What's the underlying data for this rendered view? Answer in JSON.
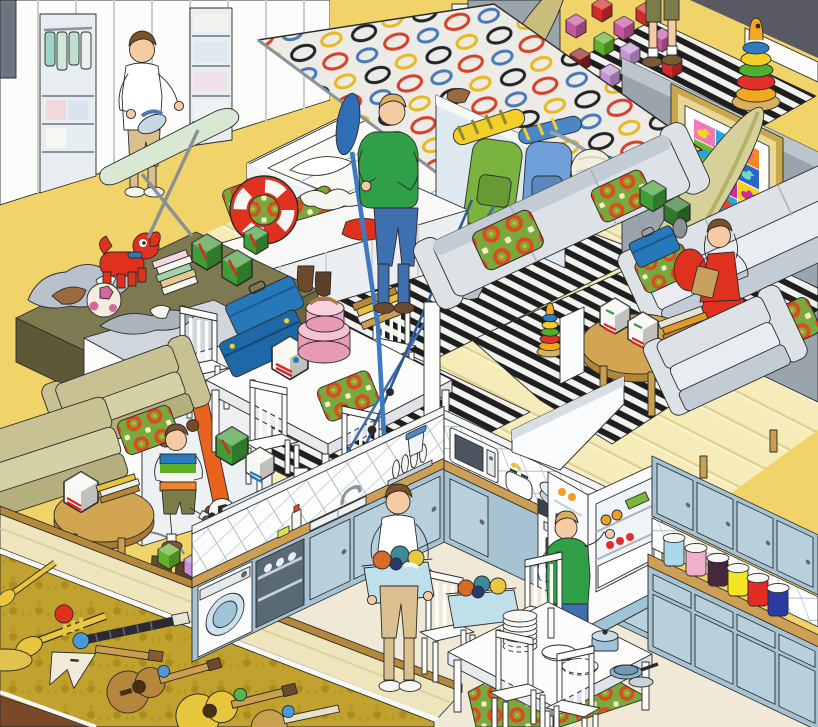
{
  "scene": {
    "title": "Isometric cutaway illustration of a cluttered family home",
    "style": "flat-color isometric cartoon with black outlines",
    "setting": "open-plan upper floor (closet, bedroom, living room, family area, kitchen) over a music room strewn with instruments"
  },
  "palette": {
    "floorYellow": "#f0d369",
    "floorPlank": "#f6ecba",
    "plankLine": "#e2d193",
    "floorCream": "#f0e9d7",
    "carpetOlive": "#c2a22e",
    "woodDark": "#7a4a28",
    "wallGray": "#9aa4ad",
    "wallGrayLight": "#bcc5cb",
    "wallDark": "#585963",
    "wardrobe": "#fcfcfa",
    "rugBlack": "#1f1f1f",
    "rugWhite": "#f1f1ee",
    "sofaGray": "#dde2e7",
    "sofaShade": "#c3ccd4",
    "oliveChair": "#c8c293",
    "oliveDesk": "#7d7950",
    "cabinetBlue": "#a6c3d4",
    "cabinetBlueDark": "#7fa8bf",
    "counterWood": "#cd9f55",
    "applianceWhite": "#fafbfc",
    "basketBlue": "#bfdfeb",
    "green": "#2fa048",
    "denim": "#3e6fae",
    "khaki": "#d9c08e",
    "skin": "#f4cba3",
    "hairBrown": "#7c512a",
    "hairBlond": "#d9b05e",
    "red": "#e0301e",
    "pillowGreen": "#79a83c",
    "pillowRed": "#e0481e",
    "suitcaseBlue": "#2678b8",
    "giftGreen": "#3f9c36",
    "hatboxPink": "#f2afc3",
    "surfPale": "#d6d199",
    "paddleBlue": "#2f6db5",
    "lampCream": "#f3efdf",
    "posterFrame": "#c8a84a",
    "boardMint": "#d9e8d2",
    "guitarBrown": "#b5863c",
    "guitarYellow": "#e8c63c",
    "trumpetGold": "#e9c63e"
  },
  "poster": {
    "name": "pop-art rubber-duck poster",
    "cells": [
      {
        "bg": "#ee79b5",
        "duck": "#f5d327"
      },
      {
        "bg": "#2aa7d8",
        "duck": "#f5862b"
      },
      {
        "bg": "#f5862b",
        "duck": "#e84a9b"
      },
      {
        "bg": "#6cb52d",
        "duck": "#2aa7d8"
      },
      {
        "bg": "#e8452b",
        "duck": "#f5d327"
      },
      {
        "bg": "#2a66c8",
        "duck": "#6cd8c8"
      },
      {
        "bg": "#28bdbd",
        "duck": "#2a66c8"
      },
      {
        "bg": "#d12a9b",
        "duck": "#f5862b"
      },
      {
        "bg": "#f5d327",
        "duck": "#d12a9b"
      },
      {
        "bg": "#8a3bc0",
        "duck": "#f5d327"
      },
      {
        "bg": "#2aa7d8",
        "duck": "#e8452b"
      },
      {
        "bg": "#ee79b5",
        "duck": "#2a66c8"
      }
    ]
  },
  "toys": {
    "stacker_rings": [
      "#f2a820",
      "#e03028",
      "#50ae30",
      "#f2d028",
      "#2f7ac0"
    ],
    "stacker_knob": "#f2a820",
    "block_colors": [
      "#c4589e",
      "#d42a28",
      "#62b12c",
      "#c493d6",
      "#a04890",
      "#8c1f1c"
    ]
  },
  "kitchen": {
    "canisters": [
      "#a9d9ea",
      "#f2afc9",
      "#45283c",
      "#f6e524",
      "#e42b24",
      "#2b3ba0"
    ]
  },
  "people": {
    "ironing_parent": {
      "activity": "ironing clothes by the wardrobes",
      "top": "#ffffff",
      "trousers": "#d9c08e",
      "hair": "#7c512a"
    },
    "paddle_man": {
      "activity": "holding a kayak paddle in the bedroom",
      "top": "#2fa048",
      "jeans": "#3e6fae",
      "hair": "#caa05a"
    },
    "reading_girl": {
      "activity": "reading a book on the sofa",
      "dress": "#e0301e",
      "sleeves": "#f2d028",
      "hair": "#7c512a",
      "shoes": "#d84a9a"
    },
    "boy": {
      "activity": "kicking a football indoors",
      "shirt_stripes": [
        "#2a7ac0",
        "#5fae28",
        "#f5f5f0",
        "#f08428"
      ],
      "shorts": "#7c7c4a"
    },
    "laundry_parent": {
      "activity": "carrying a full laundry basket",
      "top": "#ffffff",
      "trousers": "#d9c08e"
    },
    "fridge_man": {
      "activity": "taking food from the open fridge",
      "top": "#2fa048",
      "jeans": "#3e6fae",
      "hair": "#d9b05e"
    },
    "hallway_child": {
      "activity": "standing among toy blocks",
      "shorts": "#7c7c4a"
    }
  },
  "rooms": {
    "closet_laundry": [
      "white wardrobes",
      "hanging clothes",
      "folded linen shelves",
      "ironing board",
      "iron",
      "striped rug"
    ],
    "bedroom": [
      "storage bed with lifted mattress",
      "ring-patterned duvet",
      "patterned pillows",
      "surfboards",
      "kayak paddle",
      "glass partition",
      "green backpack",
      "blue backpack",
      "life ring",
      "white sideboard"
    ],
    "hallway": [
      "scattered toy blocks",
      "ring stacker",
      "striped runner",
      "dark wall"
    ],
    "living_room": [
      "duck poster on gray wall",
      "two gray sofas",
      "patterned cushions",
      "red pillow",
      "arc floor lamp",
      "round coffee table",
      "white storage boxes",
      "book stack",
      "blue suitcase",
      "green boxes",
      "small ring stacker",
      "striped rug",
      "gray armchair",
      "sneakers"
    ],
    "family_area": [
      "olive armchairs",
      "round side table",
      "white dining table",
      "spindle chairs",
      "stacked blue suitcases",
      "pink hatboxes",
      "green gift boxes",
      "red toy dog",
      "patchwork ball",
      "book piles",
      "white chest",
      "skateboard",
      "teddy bear",
      "boots",
      "blue cap",
      "fishing rods",
      "toy cubes",
      "football"
    ],
    "kitchen": [
      "blue cabinets",
      "wood countertops",
      "tiled half walls",
      "washing machine",
      "open dishwasher",
      "sink",
      "dish rack",
      "water filter jug",
      "microwave",
      "toaster",
      "stove with pots",
      "range hood",
      "open fridge with food",
      "storage canisters",
      "kitchen table",
      "plate stack",
      "bowls",
      "saucepan",
      "frying pan",
      "laundry baskets",
      "green rug"
    ],
    "music_room": [
      "olive patterned carpet",
      "acoustic guitars",
      "flying-V guitar",
      "electric guitar neck",
      "trumpets",
      "cymbal",
      "toy cubes",
      "dark wood floor"
    ]
  }
}
